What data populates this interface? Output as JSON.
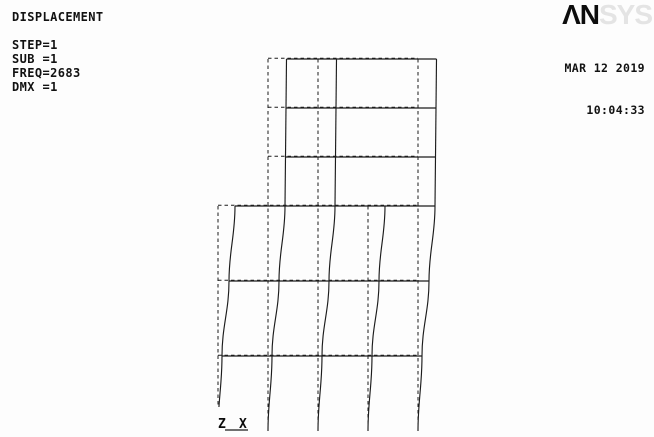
{
  "header": {
    "analysis_label": "DISPLACEMENT",
    "step_lines": [
      "STEP=1",
      "SUB =1",
      "FREQ=2683",
      "DMX =1"
    ]
  },
  "branding": {
    "logo_primary": "ΛN",
    "logo_secondary": "SYS",
    "logo_primary_color": "#0d0d0d",
    "logo_secondary_color": "#e4e4e4"
  },
  "timestamp": {
    "date": "MAR 12 2019",
    "time": "10:04:33"
  },
  "triad": {
    "z_label": "Z",
    "x_label": "X"
  },
  "colors": {
    "background": "#fdfdfd",
    "line": "#1c1c1c",
    "text": "#121212"
  },
  "model": {
    "description": "frame wireframe: dashed = undeformed, solid = deformed mode shape",
    "canvas": {
      "width": 654,
      "height": 437
    },
    "base_y": 431,
    "tower": {
      "top_y": 59,
      "floor_ys": [
        59,
        108,
        157
      ],
      "bottom_y": 206,
      "column_xs": [
        268,
        318,
        418
      ],
      "left_x": 268,
      "right_x": 418
    },
    "block": {
      "top_y": 206,
      "floor_ys": [
        206,
        281,
        356
      ],
      "column_xs": [
        218,
        268,
        318,
        368,
        418
      ],
      "left_x": 218,
      "right_x": 418
    },
    "lateral_displacement_px": {
      "59": 18.5,
      "108": 18,
      "157": 17.5,
      "206": 17,
      "281": 11,
      "356": 4,
      "431": 0
    },
    "dash_pattern": "3.5 3",
    "triad_origin": {
      "x": 218,
      "y": 428
    }
  }
}
